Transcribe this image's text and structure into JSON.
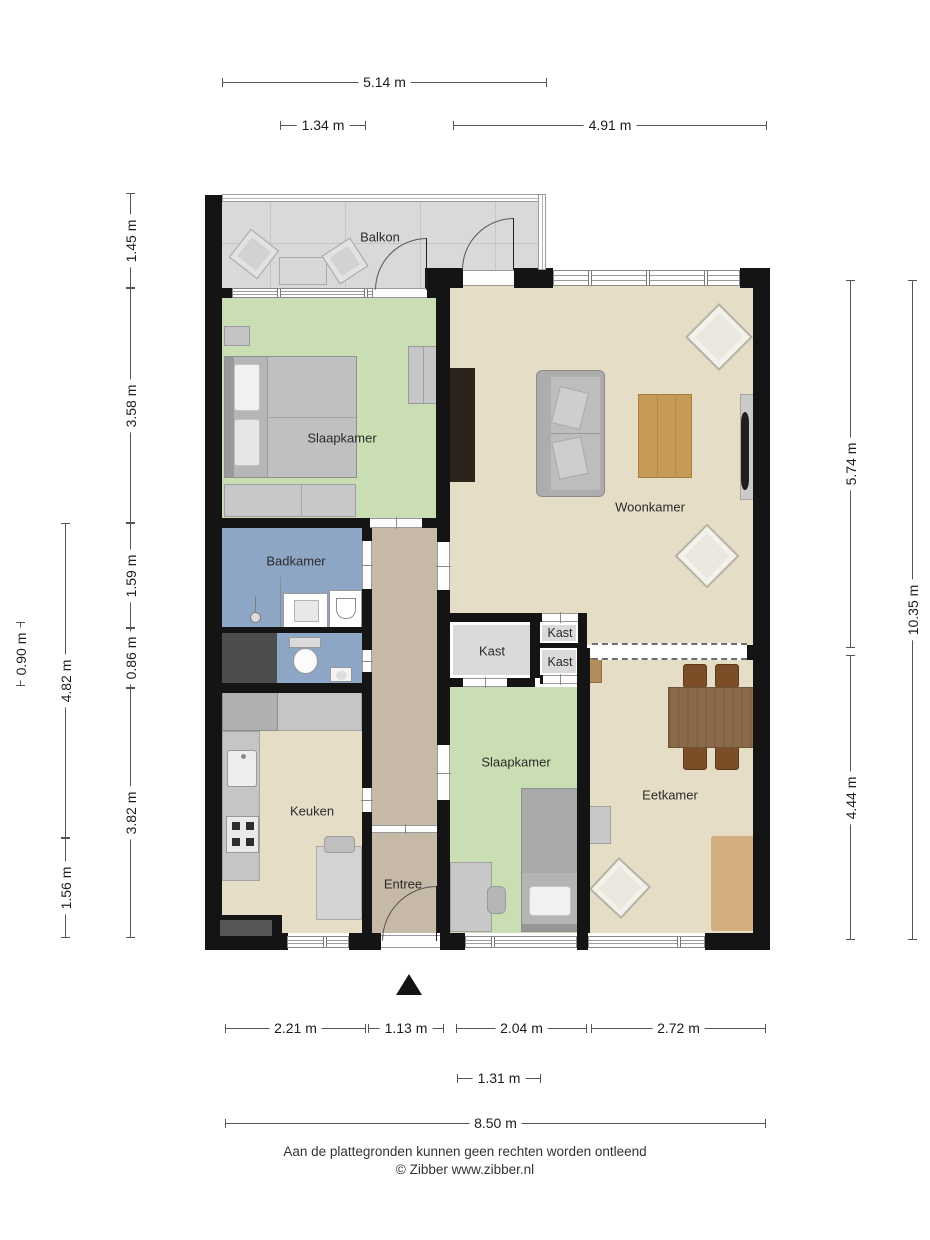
{
  "rooms": {
    "balkon": {
      "label": "Balkon"
    },
    "slaapkamer1": {
      "label": "Slaapkamer"
    },
    "woonkamer": {
      "label": "Woonkamer"
    },
    "badkamer": {
      "label": "Badkamer"
    },
    "kast_groot": {
      "label": "Kast"
    },
    "kast_boven": {
      "label": "Kast"
    },
    "kast_onder": {
      "label": "Kast"
    },
    "slaapkamer2": {
      "label": "Slaapkamer"
    },
    "eetkamer": {
      "label": "Eetkamer"
    },
    "keuken": {
      "label": "Keuken"
    },
    "entree": {
      "label": "Entree"
    }
  },
  "dimensions": {
    "top": [
      {
        "label": "5.14 m"
      },
      {
        "label": "1.34 m"
      },
      {
        "label": "4.91 m"
      }
    ],
    "left": [
      {
        "label": "1.45 m"
      },
      {
        "label": "3.58 m"
      },
      {
        "label": "1.59 m"
      },
      {
        "label": "0.86 m"
      },
      {
        "label": "3.82 m"
      },
      {
        "label": "4.82 m"
      },
      {
        "label": "1.56 m"
      },
      {
        "label": "0.90 m"
      }
    ],
    "right": [
      {
        "label": "5.74 m"
      },
      {
        "label": "4.44 m"
      },
      {
        "label": "10.35 m"
      }
    ],
    "bottom": [
      {
        "label": "2.21 m"
      },
      {
        "label": "1.13 m"
      },
      {
        "label": "2.04 m"
      },
      {
        "label": "2.72 m"
      },
      {
        "label": "1.31 m"
      },
      {
        "label": "8.50 m"
      }
    ]
  },
  "footer": {
    "line1": "Aan de plattegronden kunnen geen rechten worden ontleend",
    "line2": "© Zibber www.zibber.nl"
  },
  "colors": {
    "wall": "#141414",
    "floor_living": "#e5ddc6",
    "floor_bedroom": "#c9deb2",
    "floor_bath": "#8ea6c6",
    "floor_hall": "#c6b9a8",
    "floor_closet": "#dadada",
    "floor_balcony": "#d9d9d9",
    "shaft": "#4d4d4d"
  }
}
